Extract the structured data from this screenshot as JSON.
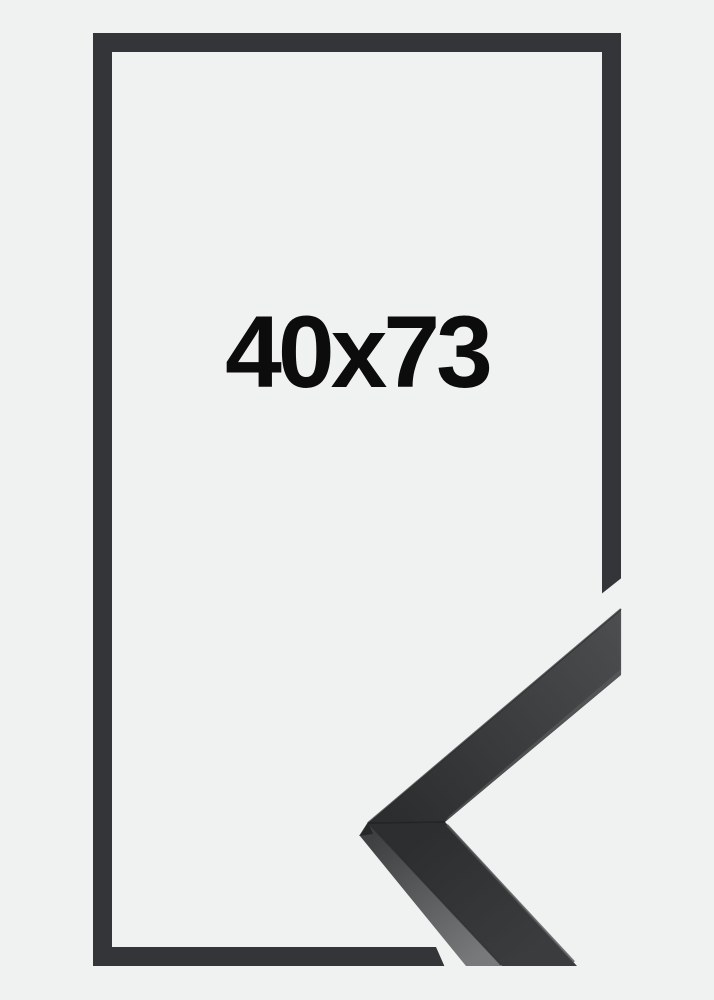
{
  "product": {
    "size_label": "40x73"
  },
  "colors": {
    "background": "#f0f1f1",
    "outline": "#333538",
    "label_text": "#0c0c0c",
    "sample_face_light": "#4b4d4f",
    "sample_face_dark": "#2b2d2f",
    "sample_lower_face_top": "#2c2e30",
    "sample_lower_face_bottom": "#3a3c3e",
    "sample_side_top": "#3e4042",
    "sample_side_bottom": "#77797b"
  }
}
